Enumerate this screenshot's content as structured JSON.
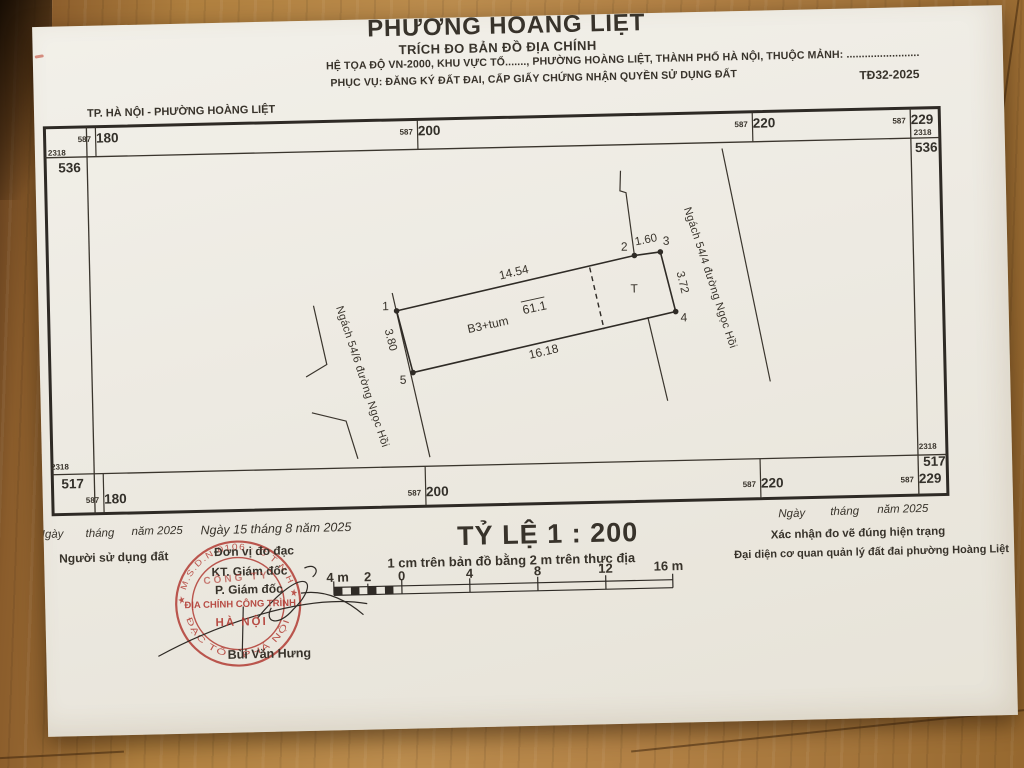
{
  "header": {
    "title": "PHƯỜNG HOÀNG LIỆT",
    "subtitle": "TRÍCH ĐO BẢN ĐỒ ĐỊA CHÍNH",
    "line3": "HỆ TỌA ĐỘ VN-2000, KHU VỰC TỔ......., PHƯỜNG HOÀNG LIỆT, THÀNH PHỐ HÀ NỘI, THUỘC MẢNH: ........................",
    "line4": "PHỤC VỤ: ĐĂNG KÝ ĐẤT ĐAI, CẤP GIẤY CHỨNG NHẬN QUYỀN SỬ DỤNG ĐẤT",
    "sheet_code": "TĐ32-2025",
    "map_label": "TP. HÀ NỘI - PHƯỜNG HOÀNG LIỆT"
  },
  "grid": {
    "e_prefix": "587",
    "n_prefix": "2318",
    "top": [
      "180",
      "200",
      "220",
      "229"
    ],
    "bottom": [
      "180",
      "200",
      "220",
      "229"
    ],
    "left": [
      "536",
      "517"
    ],
    "right": [
      "536",
      "517"
    ]
  },
  "parcel": {
    "vertices": [
      "1",
      "2",
      "3",
      "4",
      "5"
    ],
    "edge_12": "14.54",
    "edge_23": "1.60",
    "edge_34": "3.72",
    "edge_54": "16.18",
    "edge_15": "3.80",
    "area": "61.1",
    "building": "B3+tum",
    "t_label": "T"
  },
  "streets": {
    "left": "Ngách 54/6 đường Ngọc Hồi",
    "right": "Ngách 54/4 đường Ngọc Hồi"
  },
  "scale": {
    "title": "TỶ LỆ 1 : 200",
    "note": "1 cm trên bản đồ bằng 2 m trên thực địa",
    "ticks": [
      "4 m",
      "2",
      "0",
      "4",
      "8",
      "12",
      "16 m"
    ]
  },
  "signatures": {
    "left": {
      "d1": "Ngày",
      "d2": "tháng",
      "d3": "năm 2025",
      "role": "Người sử dụng đất"
    },
    "center": {
      "date": "Ngày 15 tháng 8 năm 2025",
      "org": "Đơn vị đo đạc",
      "role1": "KT. Giám đốc",
      "role2": "P. Giám đốc",
      "name": "Bùi Văn Hưng"
    },
    "right": {
      "d1": "Ngày",
      "d2": "tháng",
      "d3": "năm 2025",
      "line1": "Xác nhận đo vẽ đúng hiện trạng",
      "line2": "Đại diện cơ quan quản lý đất đai phường Hoàng Liệt"
    }
  },
  "stamp": {
    "ring_top": "★ M.S.D.N 0106 · C T N H ★",
    "ring_bottom": "ĐẠC TỔ · PHÁ NỘI",
    "arc": "CÔNG TY",
    "line1": "ĐỊA CHÍNH CÔNG TRÌNH",
    "line2": "HÀ NỘI"
  },
  "colors": {
    "stamp_red": "#b23c34",
    "ink": "#38332b",
    "paper": "#edeae2"
  }
}
